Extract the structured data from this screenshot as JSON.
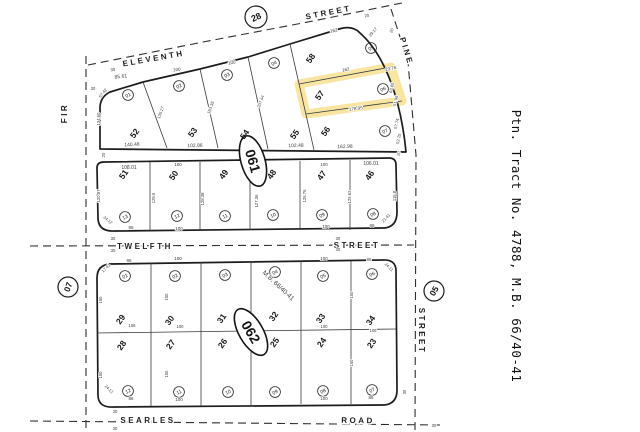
{
  "caption": {
    "text": "Ptn. Tract No. 4788, M.B. 66/40-41"
  },
  "colors": {
    "highlight": "#f3d568",
    "line": "#1c1c1c",
    "dim_text": "#3d3d3d",
    "background": "#ffffff"
  },
  "selected_parcel": {
    "lot": "57",
    "block_street": "Pine"
  },
  "streets": [
    {
      "name": "eleventh-street",
      "label": "ELEVENTH STREET"
    },
    {
      "name": "pine-street",
      "label": "PINE STREET"
    },
    {
      "name": "fir-street",
      "label": "FIR"
    },
    {
      "name": "twelfth-street",
      "label": "TWELFTH STREET"
    },
    {
      "name": "searles-road",
      "label": "SEARLES ROAD"
    }
  ],
  "map_refs": [
    {
      "name": "map-ref-28",
      "t": "28",
      "x": 256,
      "y": 17,
      "rr": 11,
      "r": -25,
      "s": 9
    },
    {
      "name": "map-ref-07",
      "t": "07",
      "x": 68,
      "y": 287,
      "rr": 10,
      "r": -70,
      "s": 8.5
    },
    {
      "name": "map-ref-05",
      "t": "05",
      "x": 434,
      "y": 291,
      "rr": 10,
      "r": -60,
      "s": 8.5
    }
  ],
  "page_ovals": [
    {
      "name": "page-oval-061",
      "t": "061",
      "x": 253,
      "y": 161,
      "rx": 12,
      "ry": 26,
      "r": 74,
      "s": 14
    },
    {
      "name": "page-oval-062",
      "t": "062",
      "x": 251,
      "y": 332,
      "rx": 12,
      "ry": 26,
      "r": 60,
      "s": 14
    }
  ],
  "parcel_circles": [
    {
      "t": "01",
      "x": 128,
      "y": 95
    },
    {
      "t": "02",
      "x": 179,
      "y": 86
    },
    {
      "t": "03",
      "x": 227,
      "y": 75
    },
    {
      "t": "04",
      "x": 274,
      "y": 63
    },
    {
      "t": "05",
      "x": 371,
      "y": 48
    },
    {
      "t": "06",
      "x": 383,
      "y": 89
    },
    {
      "t": "07",
      "x": 385,
      "y": 131
    },
    {
      "t": "13",
      "x": 125,
      "y": 217
    },
    {
      "t": "12",
      "x": 177,
      "y": 216
    },
    {
      "t": "11",
      "x": 225,
      "y": 216
    },
    {
      "t": "10",
      "x": 273,
      "y": 215
    },
    {
      "t": "09",
      "x": 322,
      "y": 215
    },
    {
      "t": "08",
      "x": 373,
      "y": 214
    },
    {
      "t": "01",
      "x": 125,
      "y": 276
    },
    {
      "t": "02",
      "x": 175,
      "y": 276
    },
    {
      "t": "03",
      "x": 225,
      "y": 275
    },
    {
      "t": "04",
      "x": 275,
      "y": 272
    },
    {
      "t": "05",
      "x": 323,
      "y": 276
    },
    {
      "t": "06",
      "x": 372,
      "y": 274
    },
    {
      "t": "12",
      "x": 128,
      "y": 391
    },
    {
      "t": "11",
      "x": 179,
      "y": 392
    },
    {
      "t": "10",
      "x": 228,
      "y": 392
    },
    {
      "t": "09",
      "x": 275,
      "y": 392
    },
    {
      "t": "08",
      "x": 323,
      "y": 391
    },
    {
      "t": "07",
      "x": 372,
      "y": 390
    }
  ],
  "labels": [
    {
      "n": "street-eleventh-label",
      "t": "ELEVENTH",
      "x": 154,
      "y": 61,
      "r": -10,
      "s": 8,
      "c": "street"
    },
    {
      "n": "street-eleventh-street-label",
      "t": "STREET",
      "x": 329,
      "y": 15,
      "r": -11,
      "s": 8,
      "c": "street"
    },
    {
      "n": "street-pine-label",
      "t": "PINE",
      "x": 404,
      "y": 52,
      "r": 73,
      "s": 8,
      "c": "street"
    },
    {
      "n": "street-fir-label",
      "t": "FIR",
      "x": 67,
      "y": 113,
      "r": -90,
      "s": 8,
      "c": "street"
    },
    {
      "n": "street-twelfth-label",
      "t": "TWELFTH",
      "x": 145,
      "y": 249,
      "r": 0,
      "s": 8,
      "c": "street"
    },
    {
      "n": "street-twelfth-street-label",
      "t": "STREET",
      "x": 357,
      "y": 248,
      "r": 0,
      "s": 8,
      "c": "street"
    },
    {
      "n": "street-searles-label",
      "t": "SEARLES",
      "x": 148,
      "y": 423,
      "r": 0,
      "s": 8,
      "c": "street"
    },
    {
      "n": "street-searles-road-label",
      "t": "ROAD",
      "x": 358,
      "y": 423,
      "r": 1,
      "s": 8,
      "c": "street"
    },
    {
      "n": "street-pine-street-label",
      "t": "STREET",
      "x": 419,
      "y": 331,
      "r": 90,
      "s": 8,
      "c": "street"
    },
    {
      "n": "tract-caption",
      "t": "Ptn. Tract No. 4788, M.B. 66/40-41",
      "x": 512,
      "y": 246,
      "r": 90,
      "s": 12.5,
      "c": "caption"
    },
    {
      "n": "mb-note-label",
      "t": "M.B. 66/40-41",
      "x": 277,
      "y": 287,
      "r": 43,
      "s": 6.5,
      "c": "dim"
    },
    {
      "n": "lot-52-label",
      "t": "52",
      "x": 137,
      "y": 135,
      "r": -55,
      "s": 8.5,
      "c": "lot",
      "i": true
    },
    {
      "n": "lot-53-label",
      "t": "53",
      "x": 195,
      "y": 134,
      "r": -55,
      "s": 8.5,
      "c": "lot",
      "i": true
    },
    {
      "n": "lot-54-label",
      "t": "54",
      "x": 247,
      "y": 136,
      "r": -55,
      "s": 8.5,
      "c": "lot",
      "i": true
    },
    {
      "n": "lot-55-label",
      "t": "55",
      "x": 297,
      "y": 136,
      "r": -55,
      "s": 8.5,
      "c": "lot",
      "i": true
    },
    {
      "n": "lot-58-label",
      "t": "58",
      "x": 313,
      "y": 60,
      "r": -55,
      "s": 8.5,
      "c": "lot",
      "i": true
    },
    {
      "n": "lot-57-label",
      "t": "57",
      "x": 322,
      "y": 97,
      "r": -55,
      "s": 8.5,
      "c": "lot",
      "i": true
    },
    {
      "n": "lot-56-label",
      "t": "56",
      "x": 328,
      "y": 133,
      "r": -55,
      "s": 8.5,
      "c": "lot",
      "i": true
    },
    {
      "n": "lot-51-label",
      "t": "51",
      "x": 126,
      "y": 176,
      "r": -55,
      "s": 8.5,
      "c": "lot",
      "i": true
    },
    {
      "n": "lot-50-label",
      "t": "50",
      "x": 176,
      "y": 177,
      "r": -55,
      "s": 8.5,
      "c": "lot",
      "i": true
    },
    {
      "n": "lot-49-label",
      "t": "49",
      "x": 226,
      "y": 176,
      "r": -55,
      "s": 8.5,
      "c": "lot",
      "i": true
    },
    {
      "n": "lot-48-label",
      "t": "48",
      "x": 274,
      "y": 176,
      "r": -55,
      "s": 8.5,
      "c": "lot",
      "i": true
    },
    {
      "n": "lot-47-label",
      "t": "47",
      "x": 324,
      "y": 177,
      "r": -55,
      "s": 8.5,
      "c": "lot",
      "i": true
    },
    {
      "n": "lot-46-label",
      "t": "46",
      "x": 372,
      "y": 177,
      "r": -55,
      "s": 8.5,
      "c": "lot",
      "i": true
    },
    {
      "n": "lot-29-label",
      "t": "29",
      "x": 123,
      "y": 321,
      "r": -55,
      "s": 8.5,
      "c": "lot",
      "i": true
    },
    {
      "n": "lot-30-label",
      "t": "30",
      "x": 172,
      "y": 322,
      "r": -55,
      "s": 8.5,
      "c": "lot",
      "i": true
    },
    {
      "n": "lot-31-label",
      "t": "31",
      "x": 224,
      "y": 320,
      "r": -55,
      "s": 8.5,
      "c": "lot",
      "i": true
    },
    {
      "n": "lot-32-label",
      "t": "32",
      "x": 276,
      "y": 318,
      "r": -55,
      "s": 8.5,
      "c": "lot",
      "i": true
    },
    {
      "n": "lot-33-label",
      "t": "33",
      "x": 323,
      "y": 320,
      "r": -55,
      "s": 8.5,
      "c": "lot",
      "i": true
    },
    {
      "n": "lot-34-label",
      "t": "34",
      "x": 373,
      "y": 322,
      "r": -55,
      "s": 8.5,
      "c": "lot",
      "i": true
    },
    {
      "n": "lot-28-label",
      "t": "28",
      "x": 124,
      "y": 347,
      "r": -55,
      "s": 8.5,
      "c": "lot",
      "i": true
    },
    {
      "n": "lot-27-label",
      "t": "27",
      "x": 173,
      "y": 346,
      "r": -55,
      "s": 8.5,
      "c": "lot",
      "i": true
    },
    {
      "n": "lot-26-label",
      "t": "26",
      "x": 225,
      "y": 345,
      "r": -55,
      "s": 8.5,
      "c": "lot",
      "i": true
    },
    {
      "n": "lot-25-label",
      "t": "25",
      "x": 277,
      "y": 344,
      "r": -55,
      "s": 8.5,
      "c": "lot",
      "i": true
    },
    {
      "n": "lot-24-label",
      "t": "24",
      "x": 324,
      "y": 344,
      "r": -55,
      "s": 8.5,
      "c": "lot",
      "i": true
    },
    {
      "n": "lot-23-label",
      "t": "23",
      "x": 374,
      "y": 345,
      "r": -55,
      "s": 8.5,
      "c": "lot",
      "i": true
    },
    {
      "n": "dim",
      "t": "85.61",
      "x": 121,
      "y": 78,
      "r": -7,
      "s": 5,
      "c": "dim"
    },
    {
      "n": "dim",
      "t": "57.42",
      "x": 104,
      "y": 94,
      "r": -52,
      "s": 4.2,
      "c": "dim"
    },
    {
      "n": "dim",
      "t": "134.60",
      "x": 100,
      "y": 119,
      "r": -90,
      "s": 4.2,
      "c": "dim"
    },
    {
      "n": "dim",
      "t": "140.48",
      "x": 132,
      "y": 146,
      "r": -3,
      "s": 5,
      "c": "dim"
    },
    {
      "n": "dim",
      "t": "100",
      "x": 177,
      "y": 71,
      "r": -8,
      "s": 4.5,
      "c": "dim"
    },
    {
      "n": "dim",
      "t": "135.27",
      "x": 162,
      "y": 113,
      "r": -70,
      "s": 4.2,
      "c": "dim"
    },
    {
      "n": "dim",
      "t": "102.86",
      "x": 195,
      "y": 147,
      "r": -2,
      "s": 5,
      "c": "dim"
    },
    {
      "n": "dim",
      "t": "100",
      "x": 232,
      "y": 64,
      "r": -9,
      "s": 4.5,
      "c": "dim"
    },
    {
      "n": "dim",
      "t": "163.35",
      "x": 212,
      "y": 108,
      "r": -70,
      "s": 4.2,
      "c": "dim"
    },
    {
      "n": "dim",
      "t": "207.44",
      "x": 262,
      "y": 102,
      "r": -70,
      "s": 4.2,
      "c": "dim"
    },
    {
      "n": "dim",
      "t": "102.48",
      "x": 296,
      "y": 147,
      "r": -2,
      "s": 5,
      "c": "dim"
    },
    {
      "n": "dim",
      "t": "162",
      "x": 334,
      "y": 32,
      "r": -10,
      "s": 4.5,
      "c": "dim"
    },
    {
      "n": "dim",
      "t": "29.17",
      "x": 374,
      "y": 33,
      "r": -50,
      "s": 4.2,
      "c": "dim"
    },
    {
      "n": "dim",
      "t": "20",
      "x": 367,
      "y": 17,
      "r": -10,
      "s": 4.2,
      "c": "dim"
    },
    {
      "n": "dim",
      "t": "20",
      "x": 393,
      "y": 31,
      "r": -72,
      "s": 4.2,
      "c": "dim"
    },
    {
      "n": "dim",
      "t": "162",
      "x": 346,
      "y": 71,
      "r": -9,
      "s": 4.5,
      "c": "dim"
    },
    {
      "n": "dim",
      "t": "23.76",
      "x": 391,
      "y": 70,
      "r": -12,
      "s": 4.5,
      "c": "dim"
    },
    {
      "n": "dim",
      "t": "178.95",
      "x": 356,
      "y": 110,
      "r": -7,
      "s": 4.5,
      "c": "dim"
    },
    {
      "n": "dim",
      "t": "162.98",
      "x": 345,
      "y": 148,
      "r": -2,
      "s": 5,
      "c": "dim"
    },
    {
      "n": "dim",
      "t": "63.65",
      "x": 393,
      "y": 88,
      "r": -78,
      "s": 4.2,
      "c": "dim"
    },
    {
      "n": "dim",
      "t": "51.96",
      "x": 397,
      "y": 101,
      "r": -78,
      "s": 4.2,
      "c": "dim"
    },
    {
      "n": "dim",
      "t": "57.74",
      "x": 398,
      "y": 124,
      "r": -78,
      "s": 4.2,
      "c": "dim"
    },
    {
      "n": "dim",
      "t": "52.25",
      "x": 400,
      "y": 139,
      "r": -78,
      "s": 4.2,
      "c": "dim"
    },
    {
      "n": "dim",
      "t": "20",
      "x": 400,
      "y": 154,
      "r": -78,
      "s": 4.2,
      "c": "dim"
    },
    {
      "n": "dim",
      "t": "30",
      "x": 93,
      "y": 90,
      "r": 0,
      "s": 4.2,
      "c": "dim"
    },
    {
      "n": "dim",
      "t": "30",
      "x": 113,
      "y": 71,
      "r": -10,
      "s": 4.2,
      "c": "dim"
    },
    {
      "n": "dim",
      "t": "20",
      "x": 105,
      "y": 155,
      "r": -90,
      "s": 4.2,
      "c": "dim"
    },
    {
      "n": "dim",
      "t": "108.01",
      "x": 129,
      "y": 169,
      "r": 0,
      "s": 5,
      "c": "dim"
    },
    {
      "n": "dim",
      "t": "100",
      "x": 178,
      "y": 166,
      "r": 0,
      "s": 4.5,
      "c": "dim"
    },
    {
      "n": "dim",
      "t": "100",
      "x": 324,
      "y": 166,
      "r": 0,
      "s": 4.5,
      "c": "dim"
    },
    {
      "n": "dim",
      "t": "106.01",
      "x": 371,
      "y": 165,
      "r": 0,
      "s": 5,
      "c": "dim"
    },
    {
      "n": "dim",
      "t": "120.87",
      "x": 100,
      "y": 196,
      "r": -90,
      "s": 4.2,
      "c": "dim"
    },
    {
      "n": "dim",
      "t": "129.5",
      "x": 155,
      "y": 198,
      "r": -90,
      "s": 4.2,
      "c": "dim"
    },
    {
      "n": "dim",
      "t": "128.38",
      "x": 204,
      "y": 199,
      "r": -90,
      "s": 4.2,
      "c": "dim"
    },
    {
      "n": "dim",
      "t": "127.36",
      "x": 258,
      "y": 201,
      "r": -90,
      "s": 4.2,
      "c": "dim"
    },
    {
      "n": "dim",
      "t": "126.76",
      "x": 306,
      "y": 196,
      "r": -90,
      "s": 4.2,
      "c": "dim"
    },
    {
      "n": "dim",
      "t": "125.62",
      "x": 351,
      "y": 197,
      "r": -90,
      "s": 4.2,
      "c": "dim"
    },
    {
      "n": "dim",
      "t": "115.8",
      "x": 396,
      "y": 196,
      "r": -90,
      "s": 4.2,
      "c": "dim"
    },
    {
      "n": "dim",
      "t": "86",
      "x": 131,
      "y": 229,
      "r": 0,
      "s": 4.5,
      "c": "dim"
    },
    {
      "n": "dim",
      "t": "100",
      "x": 179,
      "y": 230,
      "r": 0,
      "s": 4.5,
      "c": "dim"
    },
    {
      "n": "dim",
      "t": "100",
      "x": 326,
      "y": 228,
      "r": 0,
      "s": 4.5,
      "c": "dim"
    },
    {
      "n": "dim",
      "t": "86",
      "x": 372,
      "y": 227,
      "r": 0,
      "s": 4.5,
      "c": "dim"
    },
    {
      "n": "dim",
      "t": "24.12",
      "x": 107,
      "y": 221,
      "r": 40,
      "s": 4.2,
      "c": "dim"
    },
    {
      "n": "dim",
      "t": "21.41",
      "x": 387,
      "y": 219,
      "r": -45,
      "s": 4.2,
      "c": "dim"
    },
    {
      "n": "dim",
      "t": "30",
      "x": 113,
      "y": 240,
      "r": 0,
      "s": 4.2,
      "c": "dim"
    },
    {
      "n": "dim",
      "t": "30",
      "x": 113,
      "y": 252,
      "r": 0,
      "s": 4.2,
      "c": "dim"
    },
    {
      "n": "dim",
      "t": "30",
      "x": 338,
      "y": 240,
      "r": 0,
      "s": 4.2,
      "c": "dim"
    },
    {
      "n": "dim",
      "t": "30",
      "x": 338,
      "y": 251,
      "r": 0,
      "s": 4.2,
      "c": "dim"
    },
    {
      "n": "dim",
      "t": "86",
      "x": 129,
      "y": 262,
      "r": 0,
      "s": 4.5,
      "c": "dim"
    },
    {
      "n": "dim",
      "t": "100",
      "x": 178,
      "y": 260,
      "r": 0,
      "s": 4.5,
      "c": "dim"
    },
    {
      "n": "dim",
      "t": "100",
      "x": 324,
      "y": 260,
      "r": 0,
      "s": 4.5,
      "c": "dim"
    },
    {
      "n": "dim",
      "t": "86",
      "x": 369,
      "y": 261,
      "r": 0,
      "s": 4.5,
      "c": "dim"
    },
    {
      "n": "dim",
      "t": "17.41",
      "x": 107,
      "y": 269,
      "r": -45,
      "s": 4.2,
      "c": "dim"
    },
    {
      "n": "dim",
      "t": "24.11",
      "x": 388,
      "y": 268,
      "r": 45,
      "s": 4.2,
      "c": "dim"
    },
    {
      "n": "dim",
      "t": "106",
      "x": 132,
      "y": 327,
      "r": 0,
      "s": 4.2,
      "c": "dim"
    },
    {
      "n": "dim",
      "t": "100",
      "x": 180,
      "y": 328,
      "r": 0,
      "s": 4.2,
      "c": "dim"
    },
    {
      "n": "dim",
      "t": "100",
      "x": 324,
      "y": 328,
      "r": 0,
      "s": 4.2,
      "c": "dim"
    },
    {
      "n": "dim",
      "t": "106",
      "x": 373,
      "y": 332,
      "r": 0,
      "s": 4.2,
      "c": "dim"
    },
    {
      "n": "dim",
      "t": "150",
      "x": 102,
      "y": 300,
      "r": -90,
      "s": 4.2,
      "c": "dim"
    },
    {
      "n": "dim",
      "t": "150",
      "x": 102,
      "y": 375,
      "r": -90,
      "s": 4.2,
      "c": "dim"
    },
    {
      "n": "dim",
      "t": "150",
      "x": 168,
      "y": 297,
      "r": -90,
      "s": 4.2,
      "c": "dim"
    },
    {
      "n": "dim",
      "t": "150",
      "x": 168,
      "y": 374,
      "r": -90,
      "s": 4.2,
      "c": "dim"
    },
    {
      "n": "dim",
      "t": "150",
      "x": 353,
      "y": 295,
      "r": -90,
      "s": 4.2,
      "c": "dim"
    },
    {
      "n": "dim",
      "t": "150",
      "x": 353,
      "y": 363,
      "r": -90,
      "s": 4.2,
      "c": "dim"
    },
    {
      "n": "dim",
      "t": "86",
      "x": 131,
      "y": 400,
      "r": 0,
      "s": 4.5,
      "c": "dim"
    },
    {
      "n": "dim",
      "t": "100",
      "x": 179,
      "y": 401,
      "r": 0,
      "s": 4.5,
      "c": "dim"
    },
    {
      "n": "dim",
      "t": "100",
      "x": 324,
      "y": 400,
      "r": 0,
      "s": 4.5,
      "c": "dim"
    },
    {
      "n": "dim",
      "t": "86",
      "x": 371,
      "y": 399,
      "r": 0,
      "s": 4.5,
      "c": "dim"
    },
    {
      "n": "dim",
      "t": "24.12",
      "x": 108,
      "y": 390,
      "r": 45,
      "s": 4.2,
      "c": "dim"
    },
    {
      "n": "dim",
      "t": "30",
      "x": 115,
      "y": 413,
      "r": 0,
      "s": 4.2,
      "c": "dim"
    },
    {
      "n": "dim",
      "t": "30",
      "x": 115,
      "y": 430,
      "r": 0,
      "s": 4.2,
      "c": "dim"
    },
    {
      "n": "dim",
      "t": "30",
      "x": 434,
      "y": 427,
      "r": 0,
      "s": 4.2,
      "c": "dim"
    },
    {
      "n": "dim",
      "t": "30",
      "x": 406,
      "y": 392,
      "r": -90,
      "s": 4.2,
      "c": "dim"
    }
  ]
}
